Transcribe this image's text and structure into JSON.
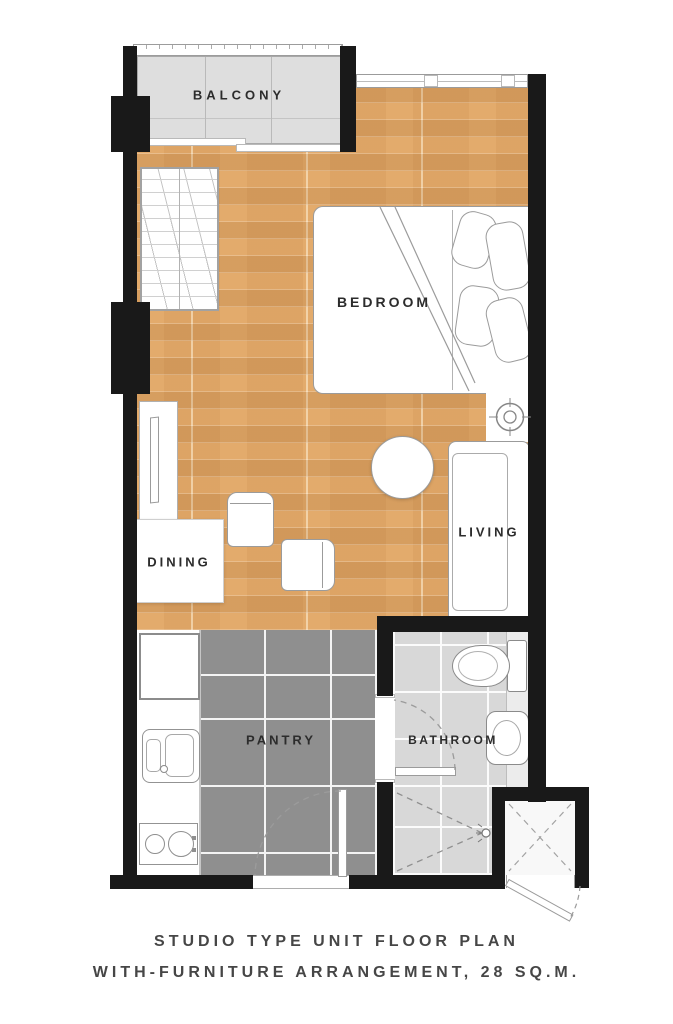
{
  "title": "Studio type unit floor plan",
  "rooms": [
    {
      "id": "balcony",
      "label": "BALCONY"
    },
    {
      "id": "bedroom",
      "label": "BEDROOM"
    },
    {
      "id": "dining",
      "label": "DINING"
    },
    {
      "id": "living",
      "label": "LIVING"
    },
    {
      "id": "pantry",
      "label": "PANTRY"
    },
    {
      "id": "bathroom",
      "label": "BATHROOM"
    }
  ],
  "caption": {
    "line1": "STUDIO TYPE UNIT FLOOR PLAN",
    "line2": "WITH-FURNITURE ARRANGEMENT, 28 SQ.M."
  },
  "area_sqm": "28",
  "fixtures": [
    "balcony-railing",
    "sliding-door",
    "window",
    "wardrobe",
    "double-bed",
    "pillows",
    "ceiling-downlight",
    "sofa",
    "round-side-table",
    "tv-console",
    "dining-table",
    "dining-chair",
    "dining-chair",
    "refrigerator",
    "kitchen-sink",
    "cooktop",
    "toilet",
    "wash-basin",
    "shower",
    "bathroom-door",
    "entrance-door",
    "service-ledge-door"
  ],
  "colors": {
    "wall": "#191919",
    "wood": "#e3ab6c",
    "balcony": "#dedede",
    "pantry": "#8f8f8f",
    "bath": "#d8d8d8",
    "label": "#2c2c2c",
    "caption": "#464646"
  }
}
